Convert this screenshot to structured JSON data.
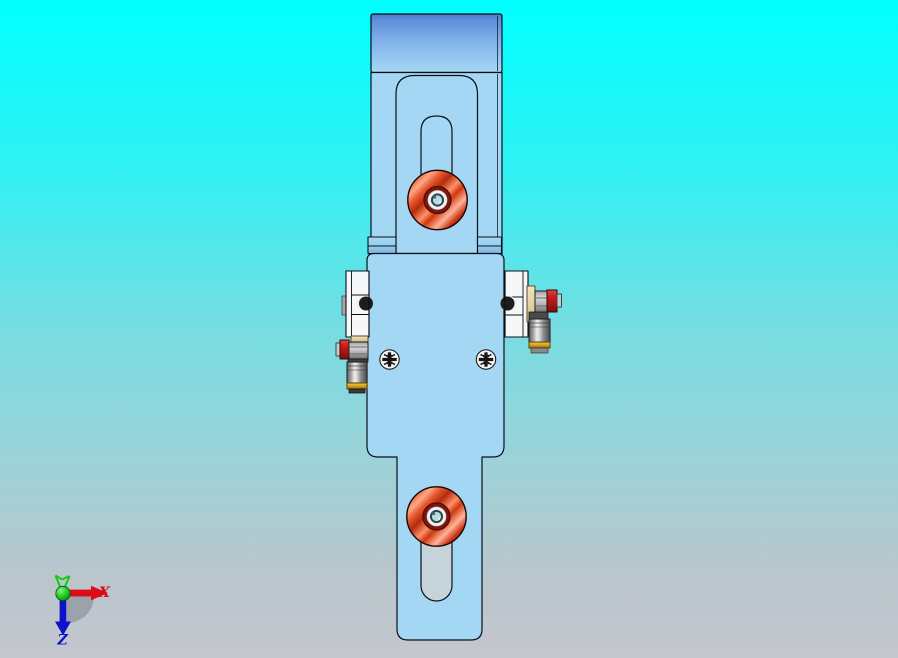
{
  "triad": {
    "x_label": "X",
    "z_label": "Z",
    "x_color": "#de0b16",
    "y_color": "#16c816",
    "z_color": "#1111cc"
  },
  "colors": {
    "background_top": "#00ffff",
    "background_bottom": "#c4c7ce",
    "part_body": "#a3d7f4",
    "part_cap_shaded": "#4d7bce",
    "roller_red": "#d23a12",
    "hub_ring_red": "#7e150a",
    "hub_center": "#b7dade",
    "slot_recess": "#c6d4da",
    "sensor_rail_white": "#f6f7f8",
    "fitting_red": "#c41a1a",
    "fitting_gold": "#d9a11f",
    "fitting_cream": "#e9d9a8",
    "fitting_metal": "#9a9a9a",
    "outline": "#0b0f16"
  }
}
